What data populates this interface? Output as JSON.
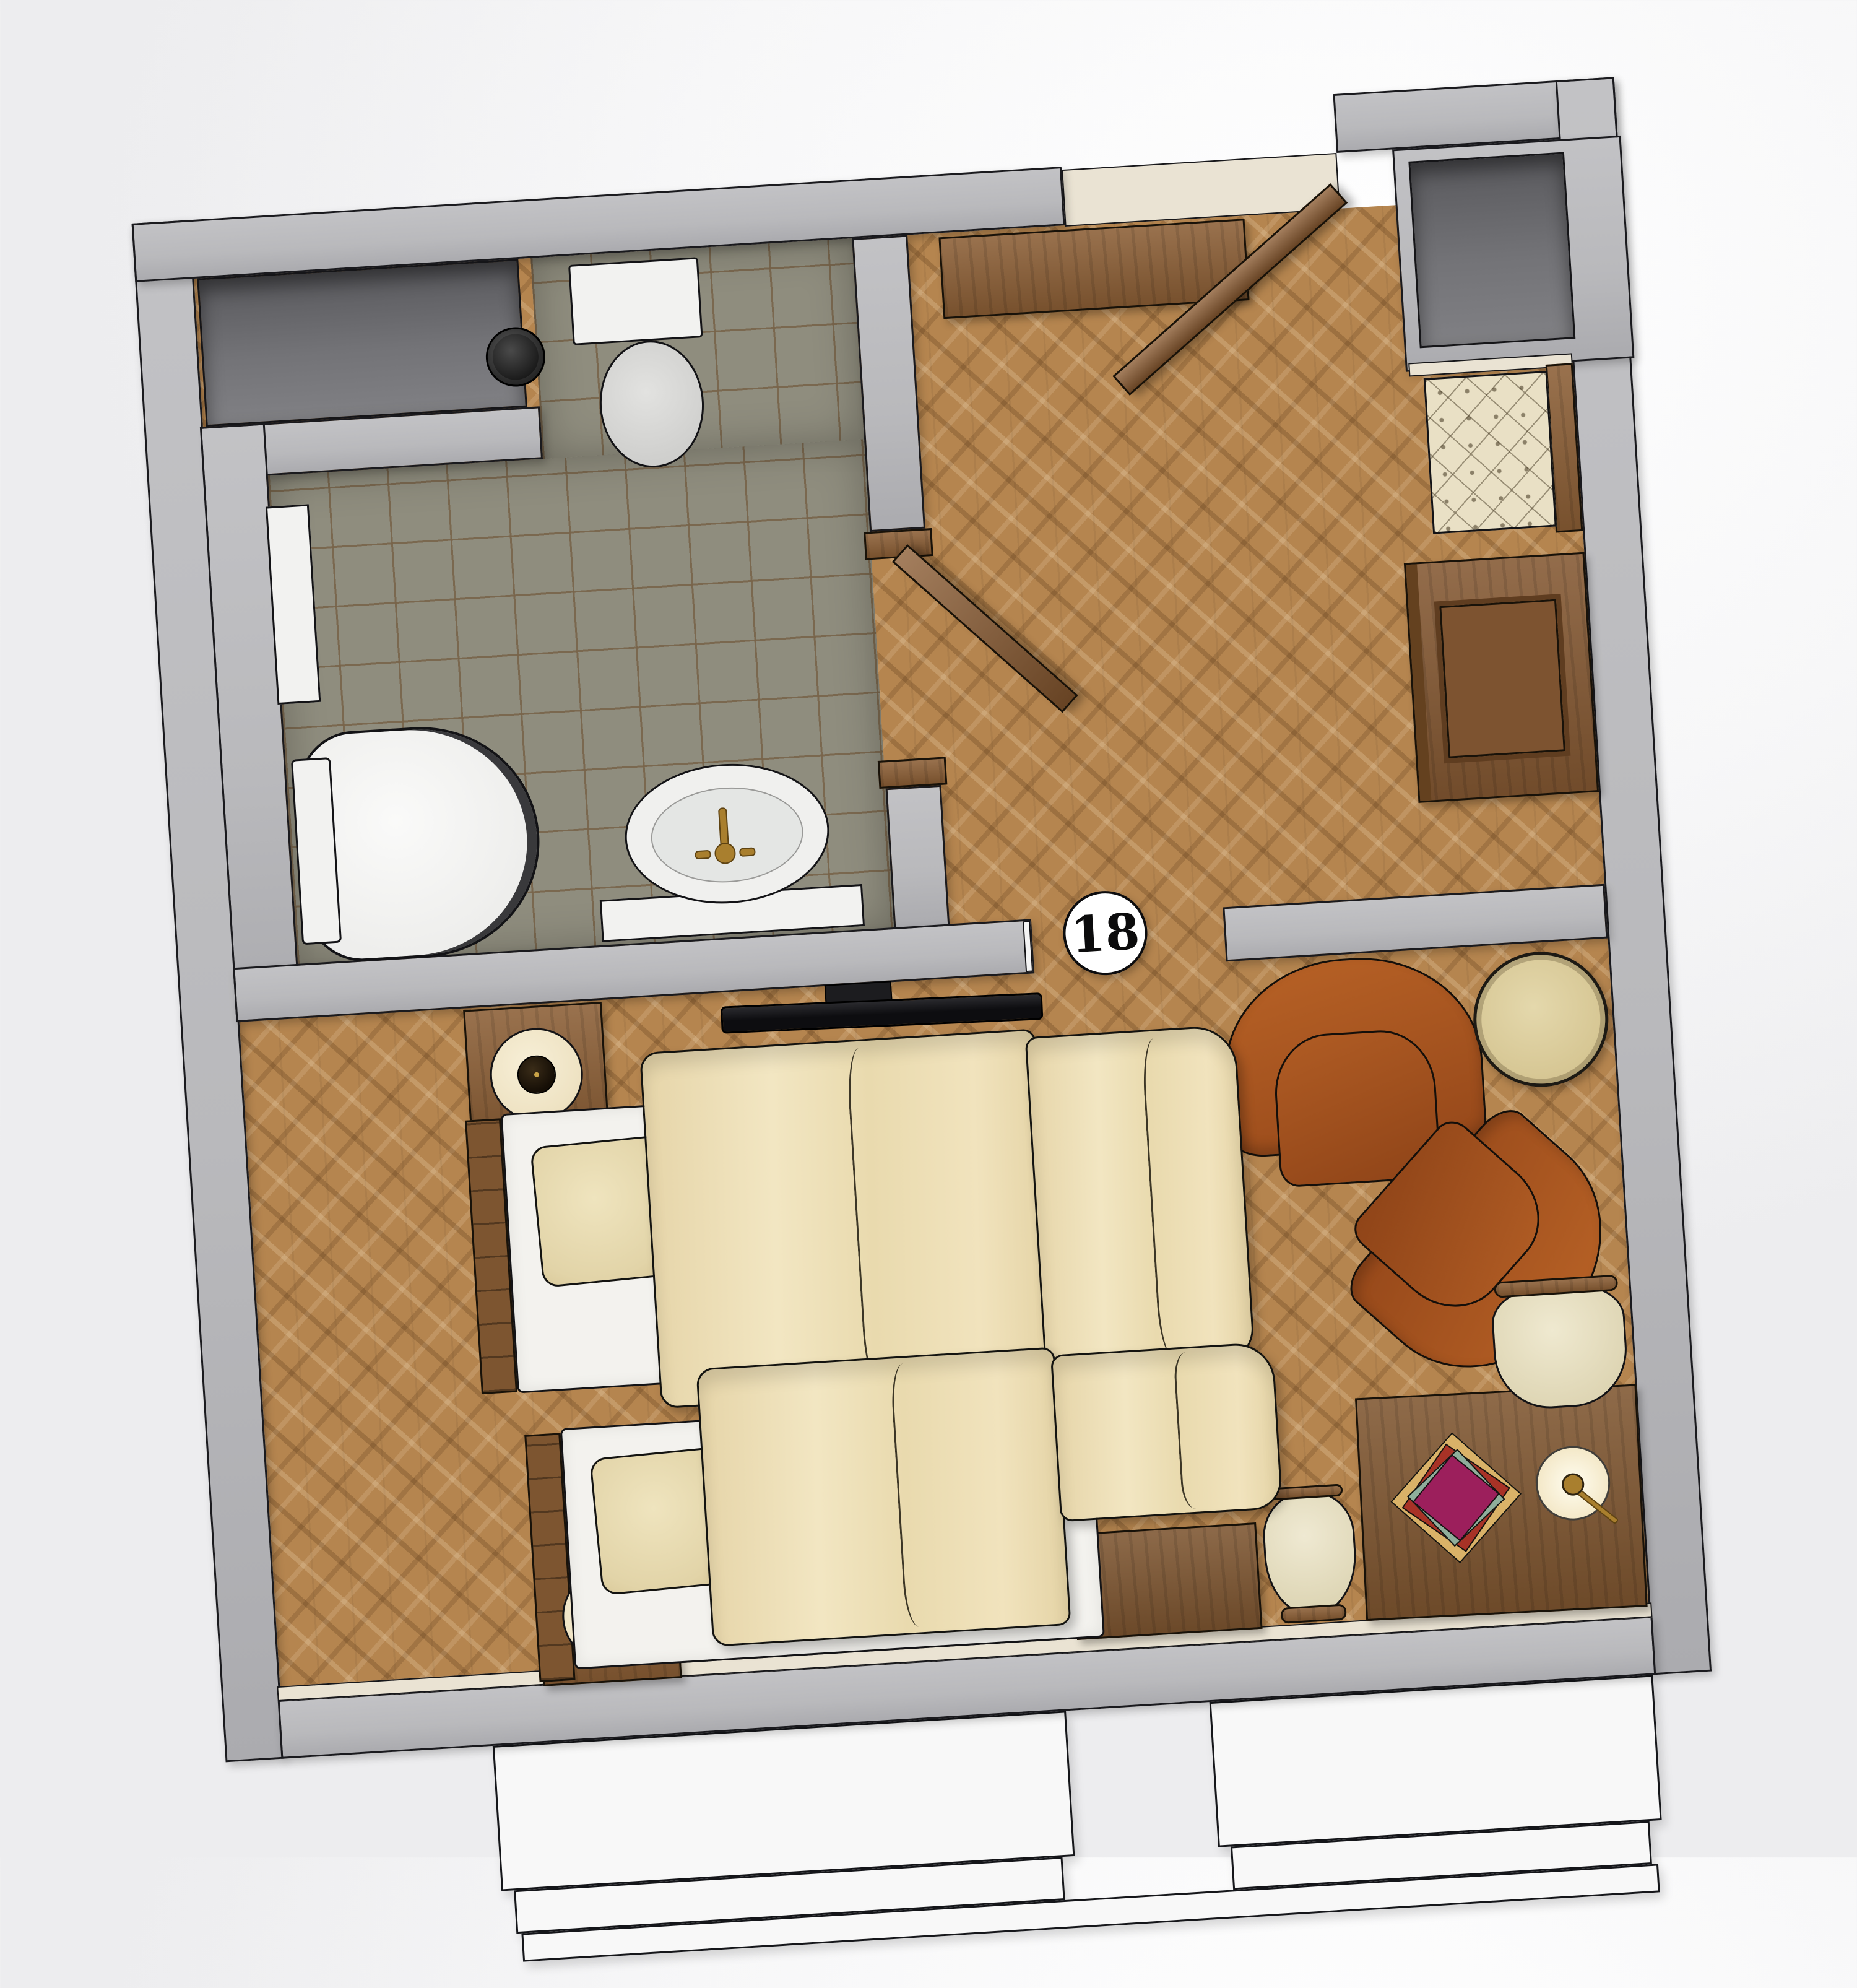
{
  "room_label": {
    "number": "18"
  },
  "palette": {
    "wall_gray": "#bcbcbf",
    "wall_niche_dark": "#6f6f73",
    "floor_parquet_oak": "#b5854f",
    "bathroom_tile_olive": "#8f8d7e",
    "furniture_wood_walnut": "#8b5e35",
    "armchair_leather": "#a8571f",
    "fabric_cream": "#e9e0c5",
    "bed_linen_cream": "#ecdeb6",
    "sanitary_white": "#f2f2f0",
    "faucet_brass": "#a97f2e",
    "tv_black": "#121214",
    "window_white": "#f8f8f8",
    "book_magenta": "#9c1f5c",
    "book_green": "#8fae9b",
    "book_red": "#a83226",
    "book_tan": "#d9b268",
    "side_table_top": "#ddd0a2"
  },
  "inventory": [
    "toilet",
    "waste-bin",
    "radiator",
    "shower",
    "sink",
    "bathroom-door",
    "entry-door",
    "console-table",
    "wall-niche",
    "tufted-bench",
    "wardrobe",
    "tv",
    "nightstand-with-lamp",
    "twin-bed",
    "window-bench",
    "stool",
    "desk",
    "book-stack",
    "desk-lamp",
    "desk-chair",
    "leather-armchair",
    "round-side-table",
    "window"
  ]
}
